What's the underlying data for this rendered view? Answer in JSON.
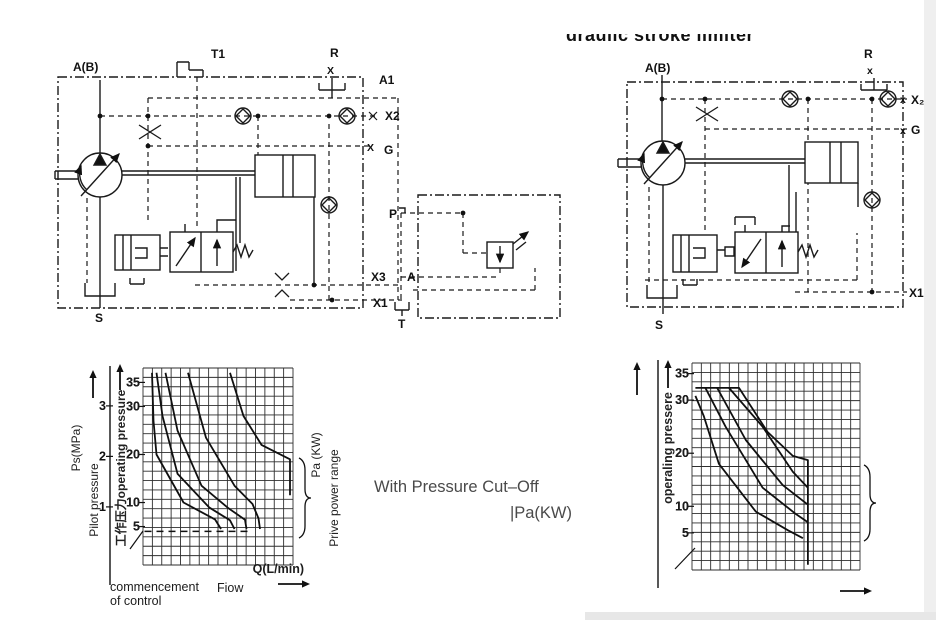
{
  "page": {
    "background": "#ffffff",
    "ink": "#1a1a1a"
  },
  "title_partial": {
    "text": "draulic stroke limiter"
  },
  "caption": {
    "line1": "With Pressure Cut–Off",
    "line2": "|Pa(KW)"
  },
  "schematic_left": {
    "name": "pump-control-circuit-with-pressure-cutoff",
    "ports": {
      "ab": "A(B)",
      "t1": "T1",
      "r": "R",
      "r_x": "X",
      "a1": "A1",
      "x2": "X2",
      "g_x": "X",
      "g": "G",
      "x3": "X3",
      "x1": "X1",
      "s": "S"
    },
    "cutoff_box": {
      "p": "P",
      "a": "A",
      "t": "T"
    }
  },
  "schematic_right": {
    "name": "pump-control-circuit-with-stroke-limiter",
    "ports": {
      "ab": "A(B)",
      "r": "R",
      "r_x": "x",
      "x2_x": "x",
      "x2": "X₂",
      "g_x": "x",
      "g": "G",
      "x1": "X1",
      "s": "S"
    }
  },
  "chart_data": [
    {
      "id": "left-performance-chart",
      "type": "line",
      "xlabel": "Q(L/min)",
      "xlabel_sub": "Fiow",
      "x_annotation_line1": "commencement",
      "x_annotation_line2": "of control",
      "ylabel_outer_unit": "Ps(MPa)",
      "ylabel_outer": "Pilot pressure",
      "ylabel_inner": "工作压力operating pressure",
      "right_label_unit": "Pa (KW)",
      "right_label": "Prive power range",
      "outer_ticks": [
        3,
        2,
        1
      ],
      "inner_ticks": [
        35,
        30,
        20,
        10,
        5
      ],
      "ylim": [
        -3,
        38
      ],
      "outer_ylim": [
        -0.15,
        3.75
      ],
      "xlim": [
        0,
        100
      ],
      "grid": true,
      "legend": "none",
      "dashed_level": 4,
      "dashed_span": [
        1,
        72
      ],
      "series": [
        {
          "name": "power-curve-1",
          "points": [
            [
              6,
              37
            ],
            [
              7,
              27
            ],
            [
              9,
              20
            ],
            [
              27,
              10
            ],
            [
              48,
              6.5
            ],
            [
              52,
              4.5
            ]
          ]
        },
        {
          "name": "power-curve-2",
          "points": [
            [
              9,
              37
            ],
            [
              13,
              28
            ],
            [
              23,
              16
            ],
            [
              44,
              9
            ],
            [
              58,
              6.3
            ],
            [
              61,
              4.5
            ]
          ]
        },
        {
          "name": "power-curve-3",
          "points": [
            [
              15,
              37
            ],
            [
              23,
              25
            ],
            [
              39,
              13.5
            ],
            [
              57,
              8.8
            ],
            [
              68,
              6.4
            ],
            [
              69,
              4.5
            ]
          ]
        },
        {
          "name": "power-curve-4",
          "points": [
            [
              30,
              37
            ],
            [
              42,
              23.5
            ],
            [
              61,
              13.5
            ],
            [
              73,
              9.7
            ],
            [
              77,
              6.7
            ],
            [
              78,
              4.5
            ]
          ]
        },
        {
          "name": "power-curve-5",
          "points": [
            [
              58,
              37
            ],
            [
              67,
              28
            ],
            [
              79,
              22
            ],
            [
              98,
              19
            ],
            [
              98,
              11.5
            ]
          ]
        }
      ]
    },
    {
      "id": "right-performance-chart",
      "type": "line",
      "ylabel_inner": "operaling pressere",
      "inner_ticks": [
        35,
        30,
        20,
        10,
        5
      ],
      "ylim": [
        -2,
        37
      ],
      "xlim": [
        0,
        100
      ],
      "grid": true,
      "legend": "none",
      "series": [
        {
          "name": "envelope-cutoff",
          "points": [
            [
              2,
              32.3
            ],
            [
              28,
              32.3
            ],
            [
              45,
              24
            ],
            [
              60,
              19.5
            ],
            [
              69,
              18.7
            ],
            [
              69,
              -1
            ]
          ]
        },
        {
          "name": "power-curve-1",
          "points": [
            [
              2,
              30.8
            ],
            [
              7,
              27
            ],
            [
              16,
              18
            ],
            [
              38,
              9
            ],
            [
              57,
              5.5
            ],
            [
              66,
              4
            ]
          ]
        },
        {
          "name": "power-curve-2",
          "points": [
            [
              8,
              32.3
            ],
            [
              20,
              25
            ],
            [
              42,
              13.5
            ],
            [
              62,
              8.5
            ],
            [
              69,
              7
            ]
          ]
        },
        {
          "name": "power-curve-3",
          "points": [
            [
              15,
              32.3
            ],
            [
              32,
              22.5
            ],
            [
              54,
              14
            ],
            [
              69,
              10.3
            ]
          ]
        },
        {
          "name": "power-curve-4",
          "points": [
            [
              22,
              32.3
            ],
            [
              42,
              25
            ],
            [
              60,
              16.5
            ],
            [
              69,
              13.5
            ]
          ]
        }
      ]
    }
  ]
}
